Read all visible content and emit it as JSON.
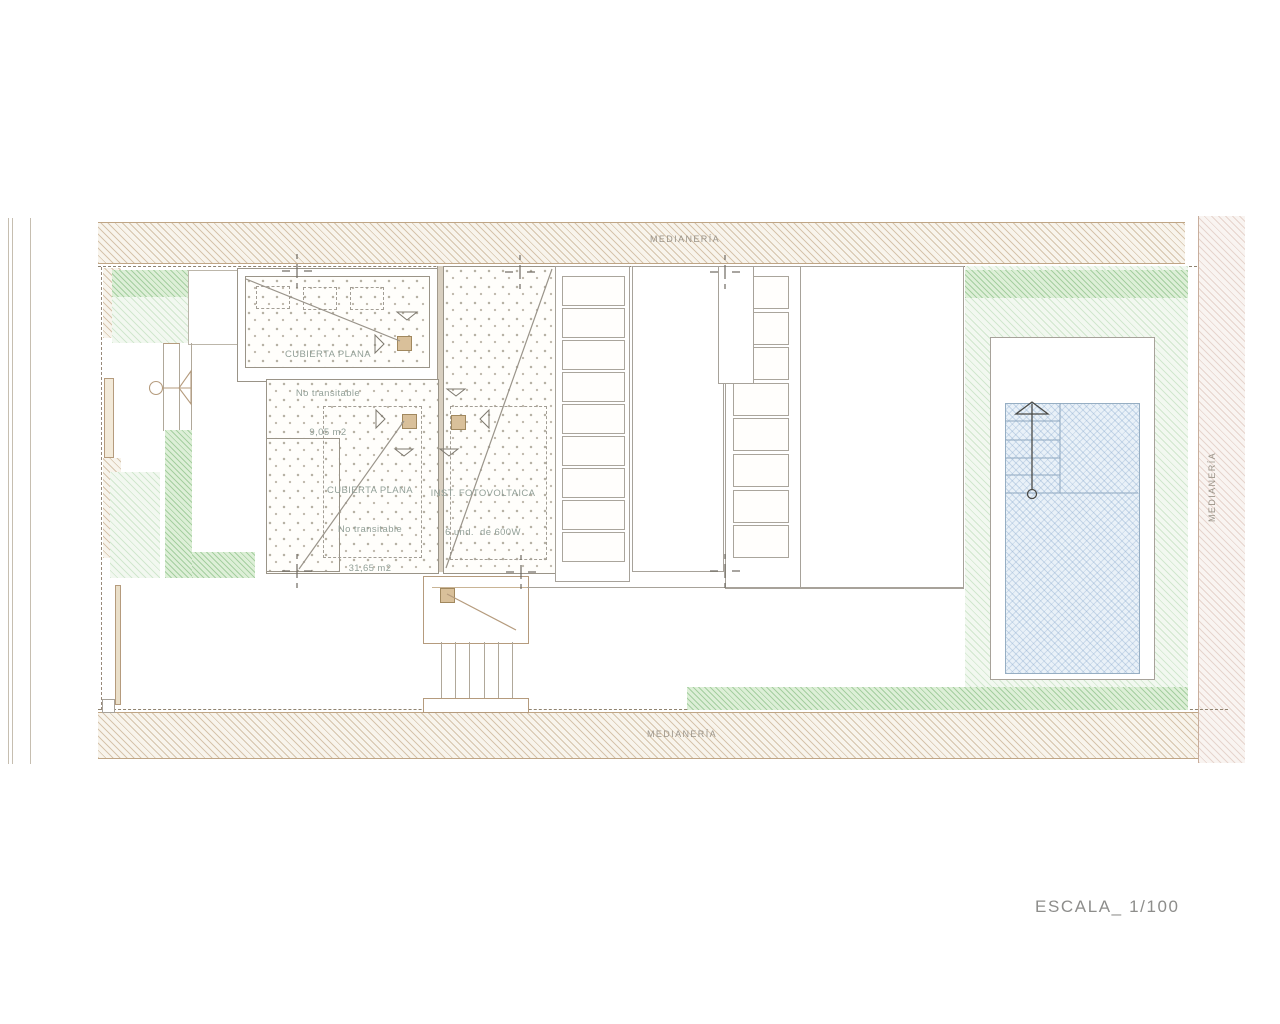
{
  "document": {
    "type": "architectural-roof-plan",
    "scale_label": "ESCALA_ 1/100",
    "party_wall_labels": {
      "top": "MEDIANERÍA",
      "bottom": "MEDIANERÍA",
      "right": "MEDIANERÍA"
    },
    "annotations": {
      "roof_small": {
        "line1": "CUBIERTA PLANA",
        "line2": "No transitable",
        "line3": "9,05 m2"
      },
      "roof_large": {
        "line1": "CUBIERTA PLANA",
        "line2": "No transitable",
        "line3": "31,65 m2"
      },
      "photovoltaic": {
        "line1": "INST. FOTOVOLTAICA",
        "line2": "6 und.  de 600W"
      }
    },
    "icons": {
      "north-arrow-icon": "line-arrow with circle base (pool)",
      "door-swing-icon": "circle + triangle",
      "survey-cross-icon": "+ with flanking dashes",
      "flow-arrow-icon": "open triangle",
      "hvac-unit-icon": "small tan square"
    },
    "palette": {
      "party_wall_hatch": "#c9b193",
      "party_wall_bg": "#f8f4ec",
      "right_wall_hatch": "#d9c0b4",
      "garden_green": "#9ecf98",
      "garden_green_light": "#cfe6cc",
      "pool_blue": "#a9c4dd",
      "line_gray": "#a7a29a",
      "line_tan": "#b59b7d",
      "annotation_text": "#92a098",
      "unit_tan": "#d9c09a"
    }
  }
}
